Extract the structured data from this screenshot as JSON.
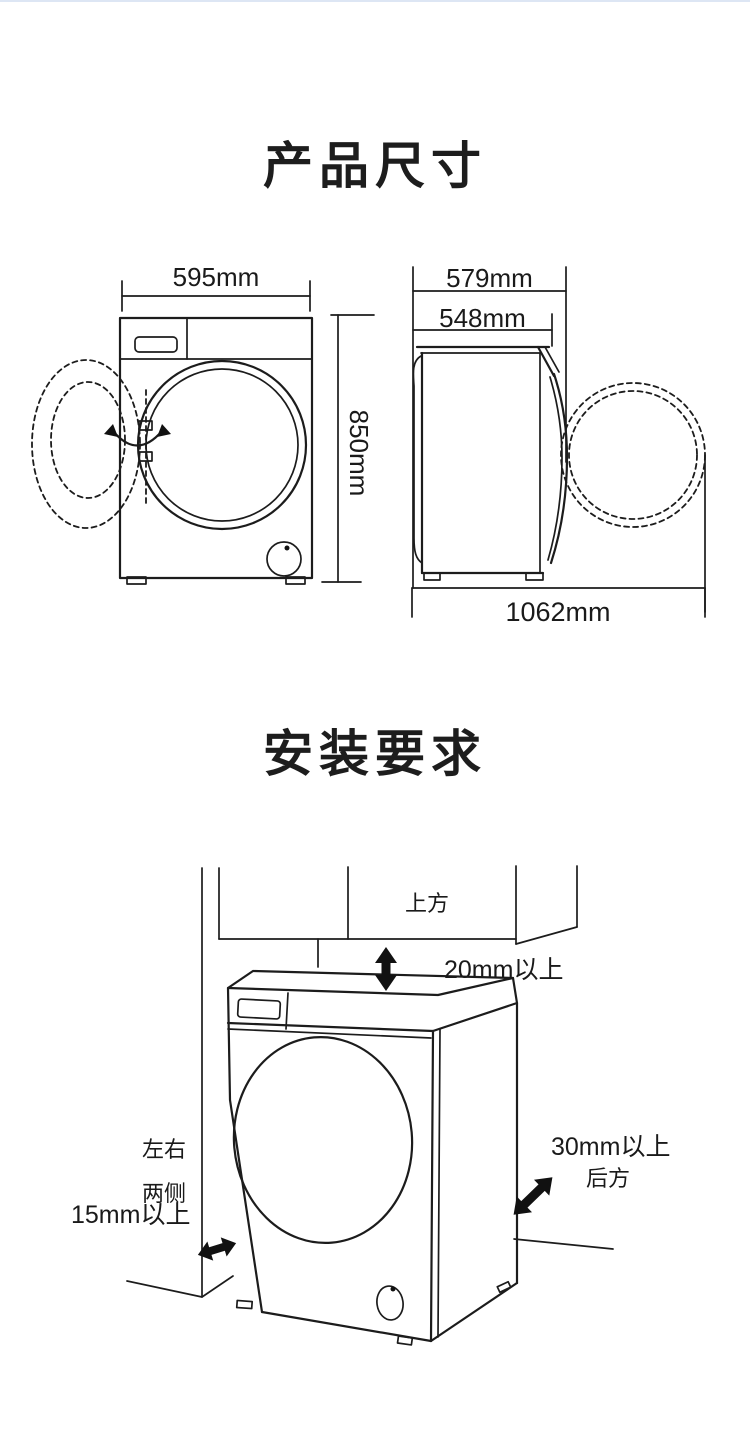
{
  "page": {
    "background": "#ffffff",
    "accent_top_border": "#dde6f4",
    "line_color": "#1c1c1c"
  },
  "product_dimensions": {
    "title": "产品尺寸",
    "front_width": "595mm",
    "front_height": "850mm",
    "side_depth_outer": "579mm",
    "side_depth_body": "548mm",
    "depth_door_open": "1062mm"
  },
  "installation": {
    "title": "安装要求",
    "above_label": "上方",
    "above_clearance": "20mm以上",
    "sides_label_line1": "左右",
    "sides_label_line2": "两侧",
    "sides_clearance": "15mm以上",
    "rear_clearance": "30mm以上",
    "rear_label": "后方"
  }
}
